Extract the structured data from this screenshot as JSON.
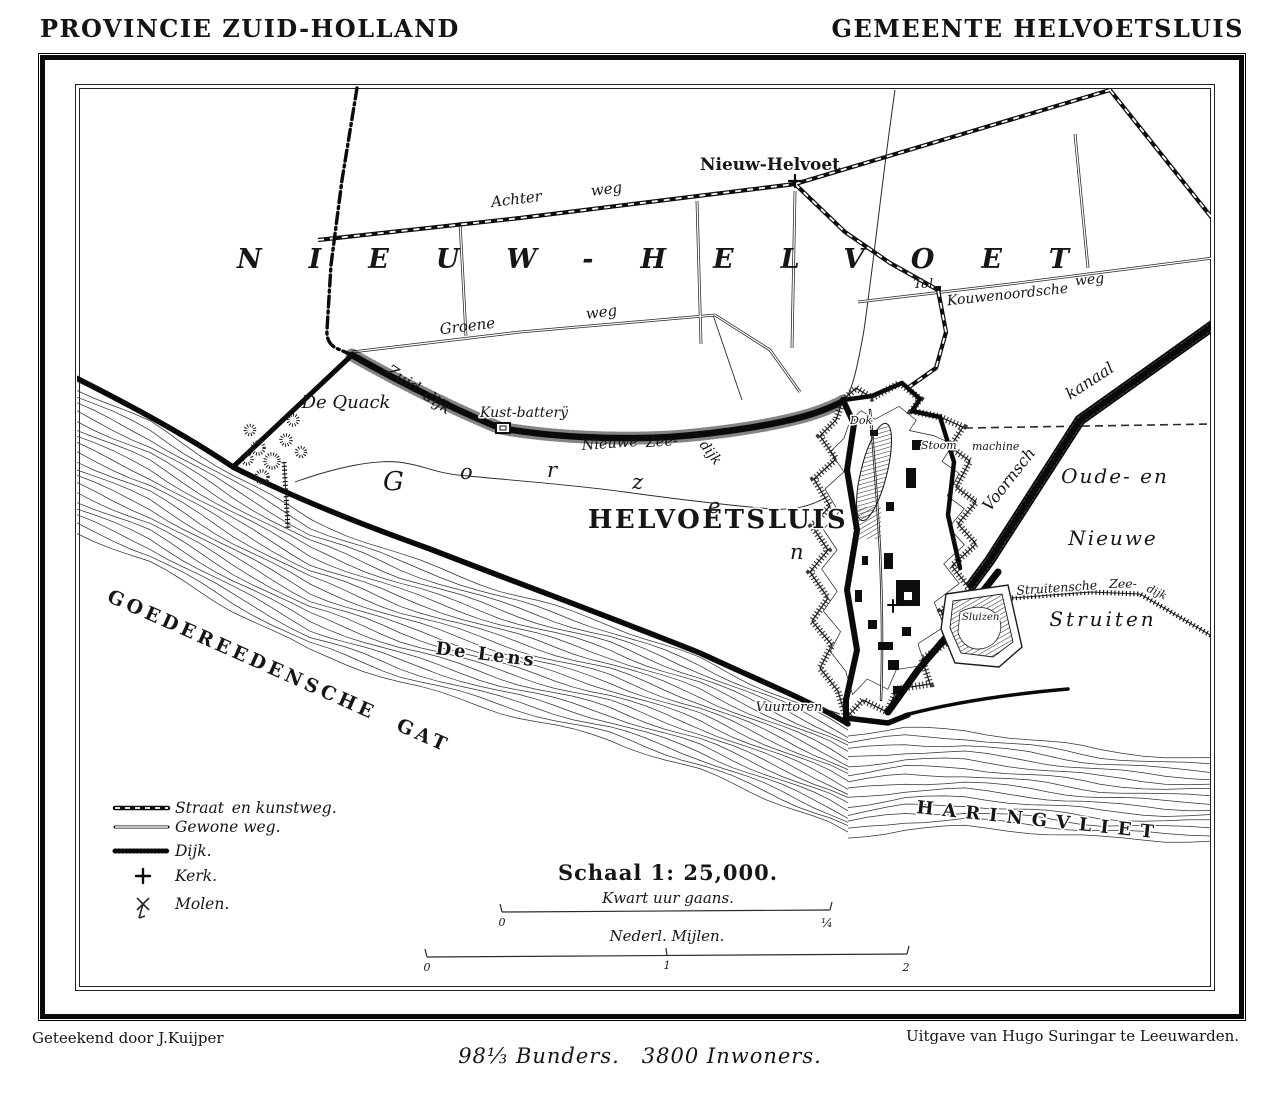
{
  "page": {
    "header_left": "PROVINCIE ZUID-HOLLAND",
    "header_right": "GEMEENTE HELVOETSLUIS",
    "credit_left": "Geteekend door J.Kuijper",
    "credit_right": "Uitgave van Hugo Suringar te Leeuwarden.",
    "statistics": "98⅓ Bunders. 3800 Inwoners."
  },
  "map": {
    "region_name": "NIEUW-HELVOET",
    "village": "Nieuw-Helvoet",
    "town": "HELVOETSLUIS",
    "marsh_letters": [
      "G",
      "o",
      "r",
      "z",
      "e",
      "n"
    ],
    "water": {
      "southwest": "GOEDEREEDENSCHE  GAT",
      "channel": "De Lens",
      "southeast": "HARINGVLIET"
    },
    "labels": {
      "achter": "Achter",
      "weg_a": "weg",
      "groene": "Groene",
      "weg_g": "weg",
      "zuid_dijk": "Zuid dijk",
      "kouwenoordsche": "Kouwenoordsche",
      "weg_k": "weg",
      "tol": "Tol",
      "de_quack": "De Quack",
      "kust_batterij": "Kust-batterÿ",
      "nieuwe_zeedijk_1": "Nieuwe",
      "nieuwe_zeedijk_2": "Zee-",
      "nieuwe_zeedijk_3": "dijk",
      "voornsch": "Voornsch",
      "kanaal": "kanaal",
      "dok": "Dok",
      "stoom": "Stoom",
      "machine": "machine",
      "sluizen": "Sluizen",
      "vuurtoren": "Vuurtoren",
      "struitensche": "Struitensche",
      "zee_s": "Zee-",
      "dijk_s": "dijk",
      "oude_en": "Oude- en",
      "nieuwe_s": "Nieuwe",
      "struiten": "Struiten"
    }
  },
  "legend": {
    "items": [
      {
        "symbol": "paved-road-symbol",
        "label": "Straat en kunstweg."
      },
      {
        "symbol": "ordinary-road-symbol",
        "label": "Gewone weg."
      },
      {
        "symbol": "dike-symbol",
        "label": "Dijk."
      },
      {
        "symbol": "church-symbol",
        "label": "Kerk."
      },
      {
        "symbol": "windmill-symbol",
        "label": "Molen."
      }
    ]
  },
  "scale": {
    "title": "Schaal 1: 25,000.",
    "bar1_label": "Kwart uur gaans.",
    "bar1_start": "0",
    "bar1_end": "¼",
    "bar2_label": "Nederl. Mijlen.",
    "bar2_start": "0",
    "bar2_mid": "1",
    "bar2_end": "2"
  }
}
